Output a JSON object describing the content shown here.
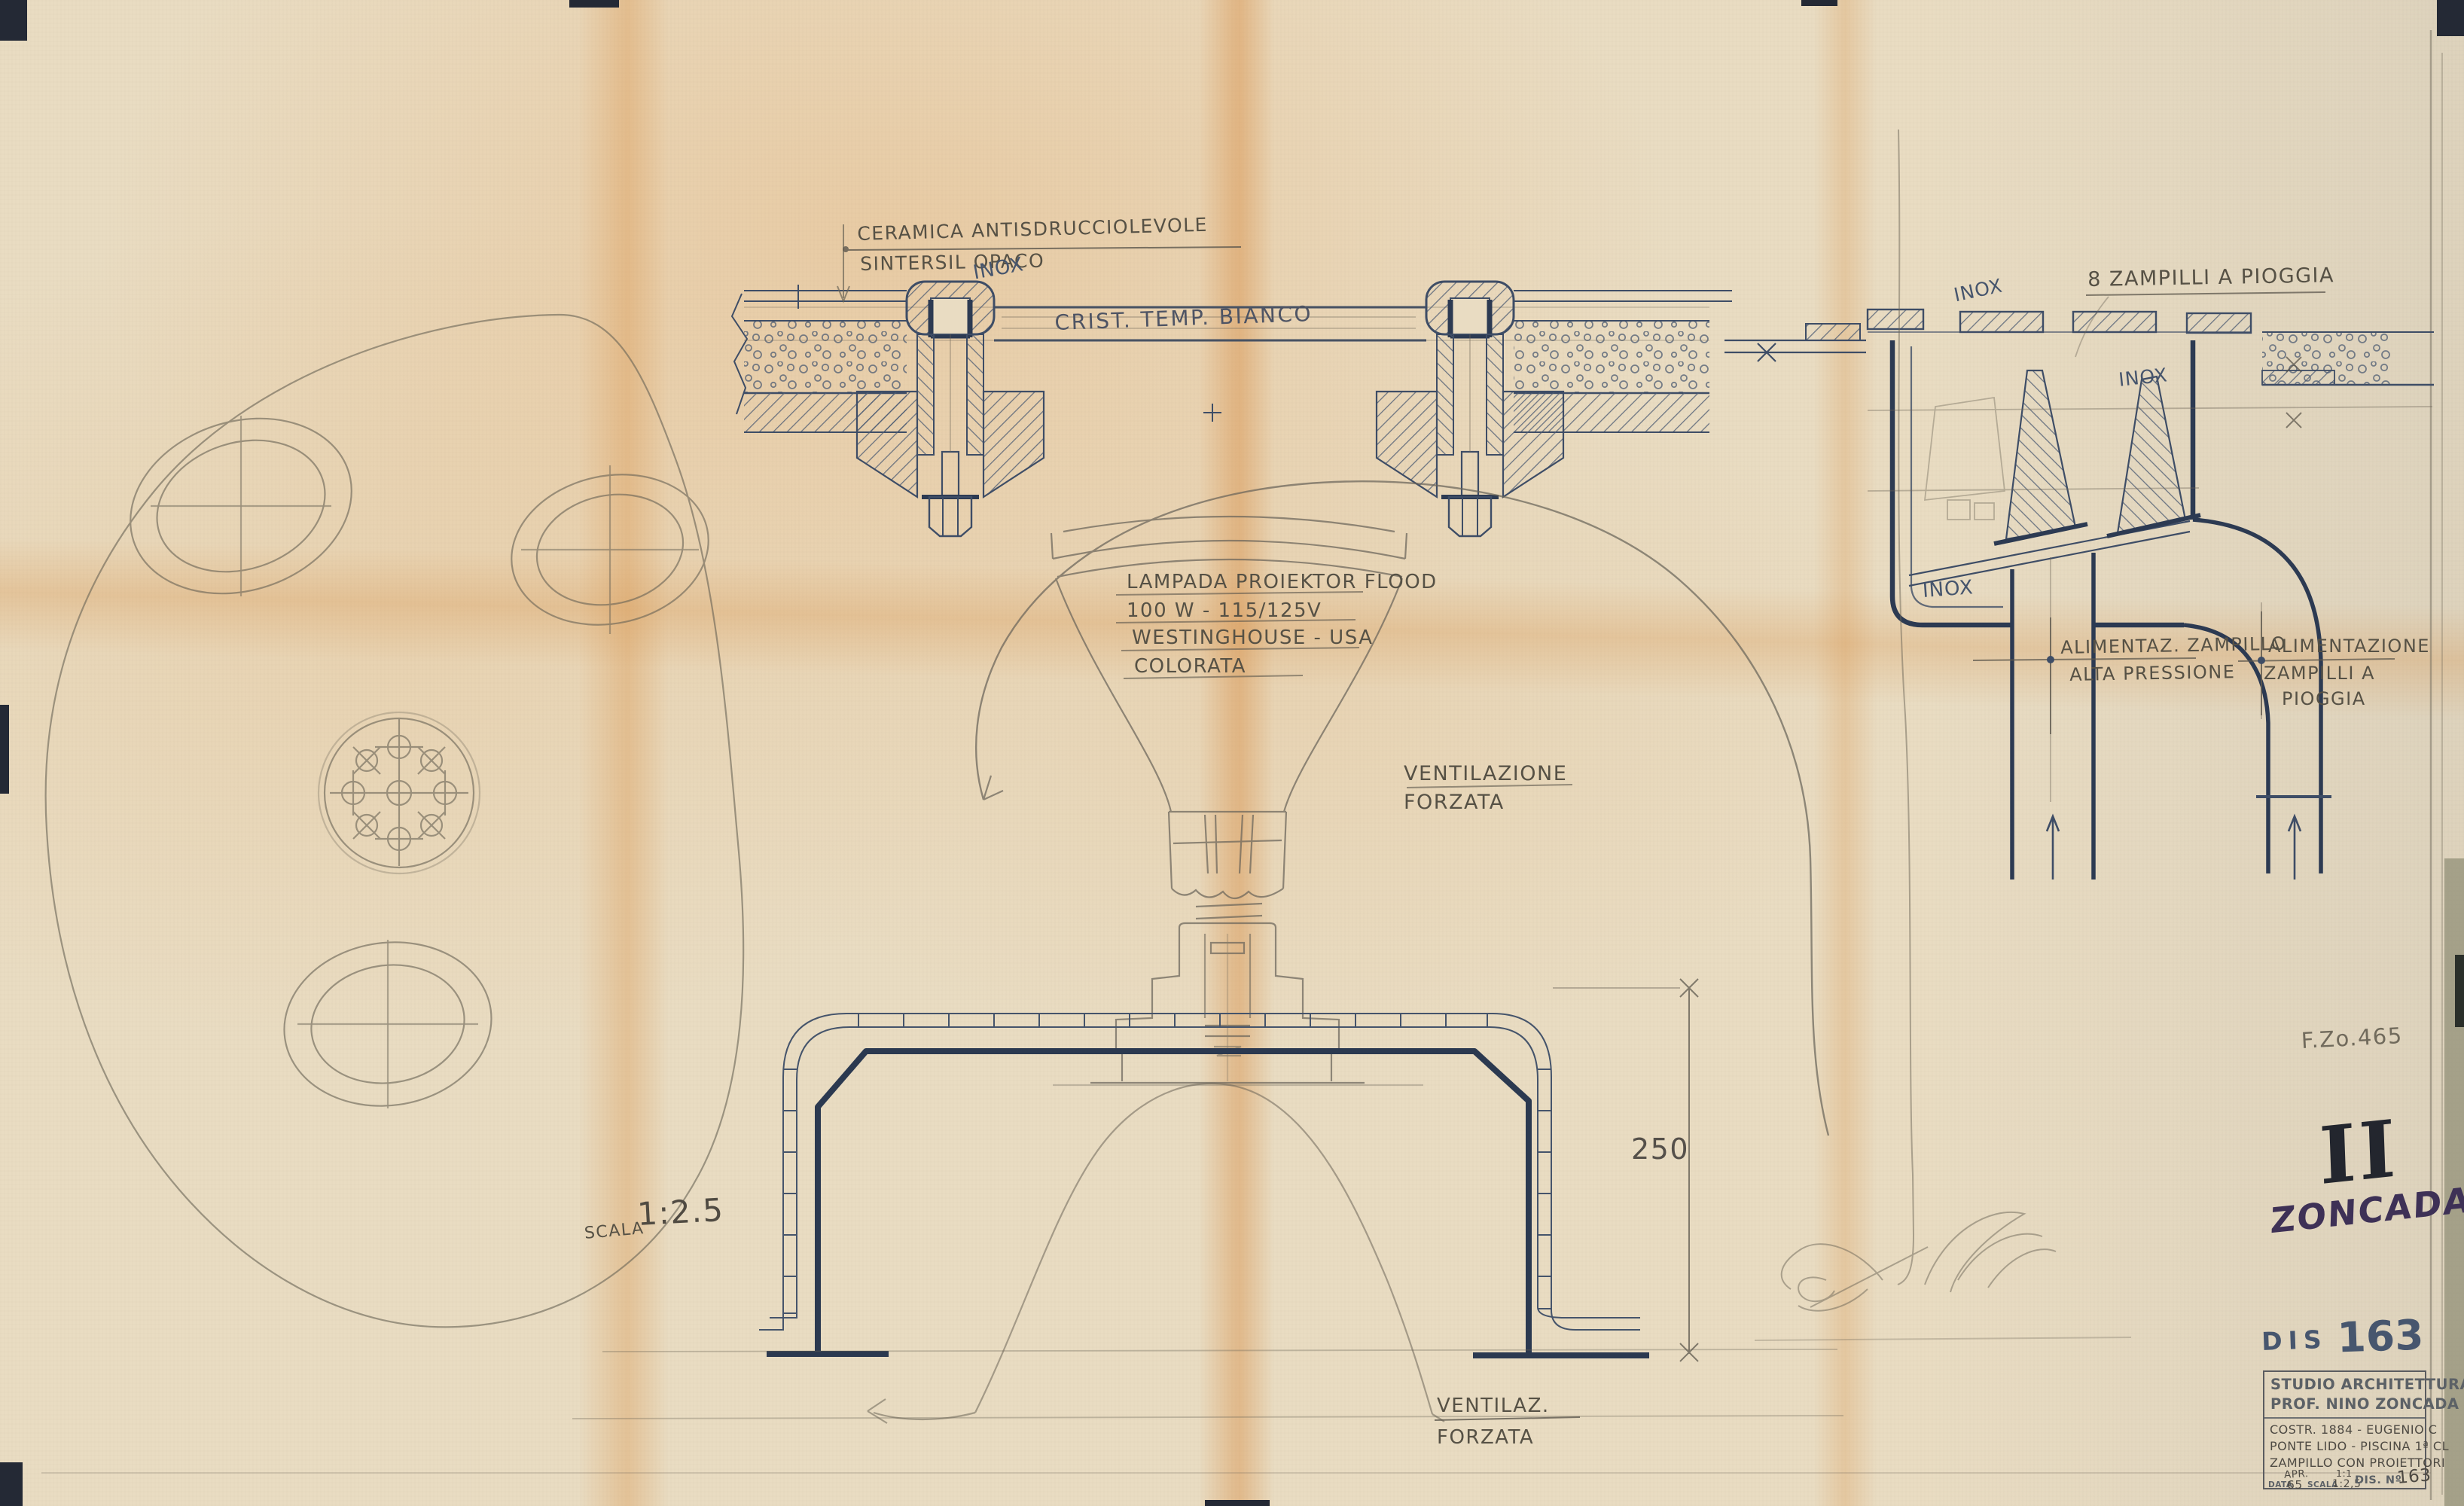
{
  "drawing": {
    "plan": {
      "scale_word": "SCALA",
      "scale_value": "1:2.5"
    },
    "glass_section": {
      "ceramic_note_line1": "CERAMICA ANTISDRUCCIOLEVOLE",
      "ceramic_note_line2": "SINTERSIL OPACO",
      "inox": "INOX",
      "glass_label": "CRIST. TEMP. BIANCO"
    },
    "nozzle_section": {
      "rain_jets": "8 ZAMPILLI A PIOGGIA",
      "inox_top": "INOX",
      "inox_mid": "INOX",
      "inox_bottom": "INOX",
      "feed_jet_line1": "ALIMENTAZ. ZAMPILLO",
      "feed_jet_line2": "ALTA PRESSIONE",
      "feed_rain_line1": "ALIMENTAZIONE",
      "feed_rain_line2": "ZAMPILLI A",
      "feed_rain_line3": "PIOGGIA"
    },
    "lamp": {
      "spec_line1": "LAMPADA PROIEKTOR FLOOD",
      "spec_line2": "100 W - 115/125V",
      "spec_line3": "WESTINGHOUSE - USA",
      "spec_line4": "COLORATA",
      "vent_line1": "VENTILAZIONE",
      "vent_line2": "FORZATA"
    },
    "housing": {
      "dimension": "250",
      "vent_line1": "VENTILAZ.",
      "vent_line2": "FORZATA"
    },
    "marks": {
      "ref_pencil": "F.Zo.465",
      "sheet_numeral": "II",
      "signature": "ZONCADA",
      "dis_prefix": "DIS",
      "dis_number": "163"
    },
    "title_block": {
      "line1": "STUDIO ARCHITETTURA",
      "line2": "PROF. NINO ZONCADA",
      "desc1": "COSTR. 1884 - EUGENIO C",
      "desc2": "PONTE LIDO - PISCINA 1ª CL",
      "desc3": "ZAMPILLO CON PROIETTORI",
      "data_label": "DATA",
      "data_value1": "APR.",
      "data_value2": "65",
      "scala_label": "SCALA",
      "scala_value1": "1:1",
      "scala_value2": "1:2,5",
      "dis_label": "DIS. Nº",
      "dis_value": "163"
    }
  }
}
